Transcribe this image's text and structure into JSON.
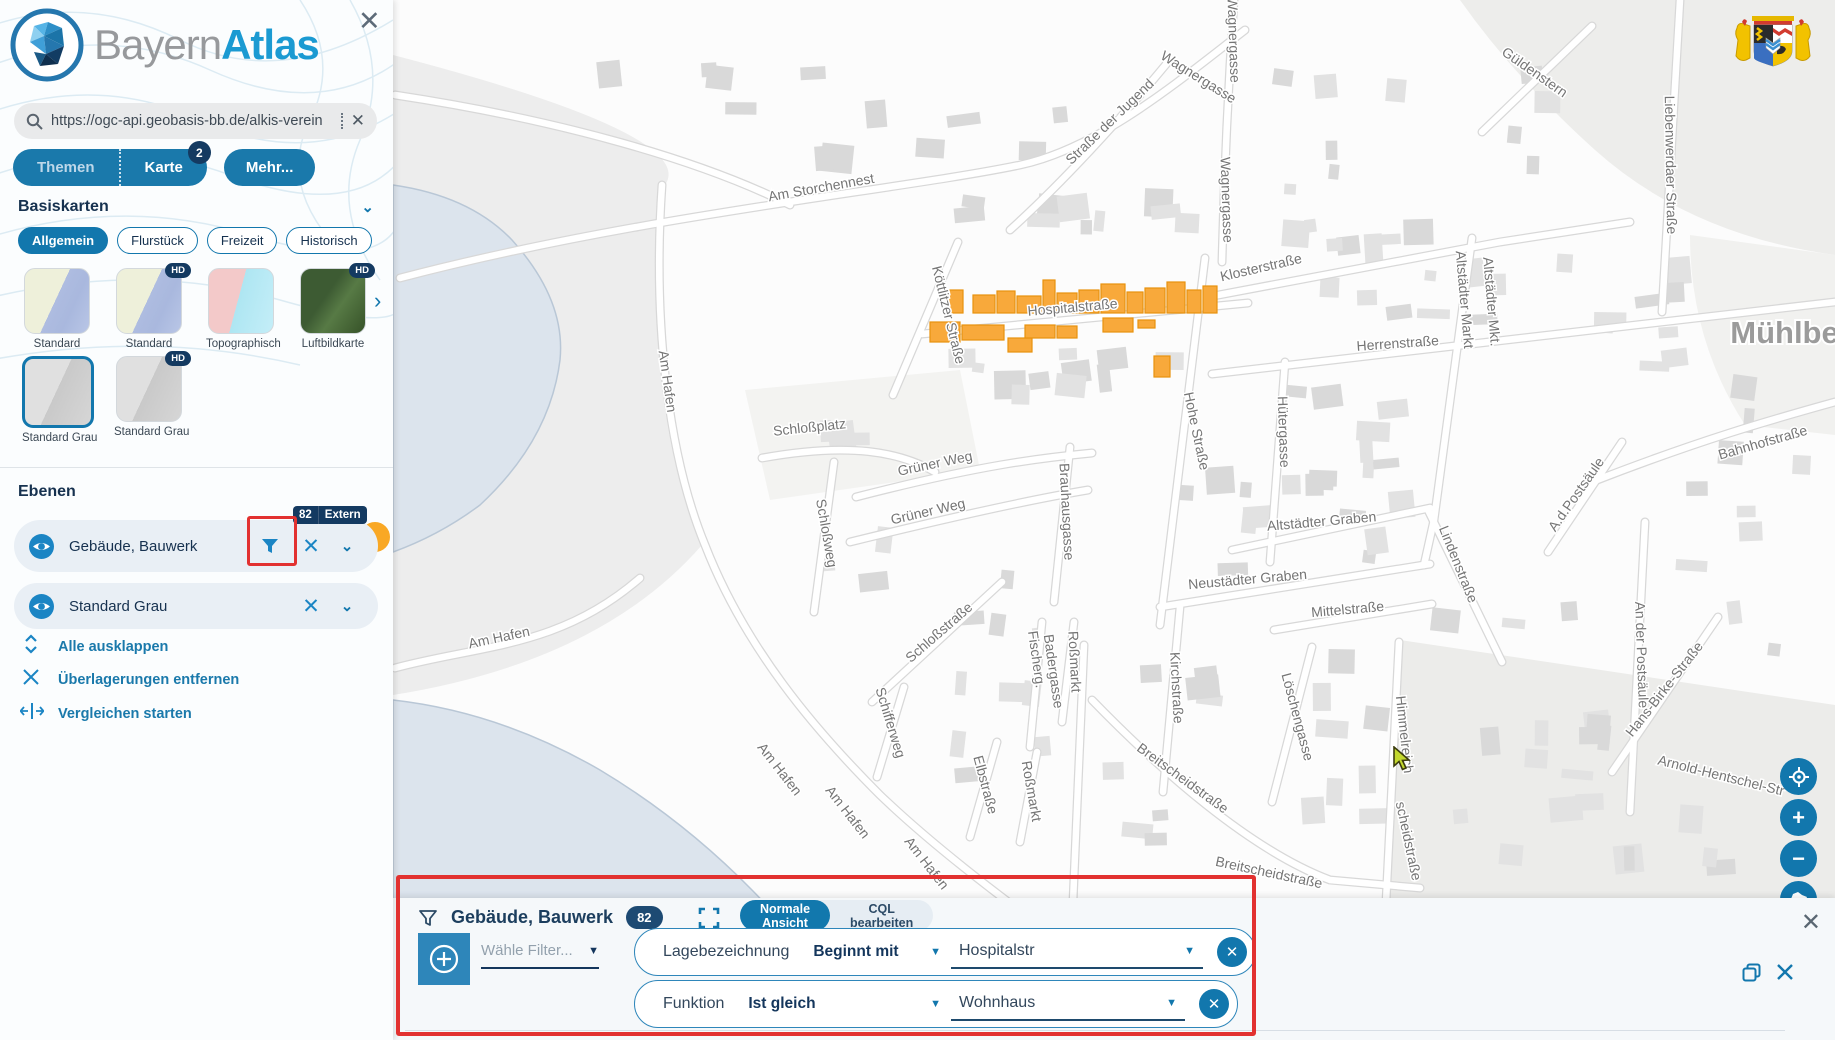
{
  "brand": {
    "name_light": "Bayern",
    "name_bold": "Atlas"
  },
  "sidebar": {
    "close_icon": "✕",
    "search": {
      "value": "https://ogc-api.geobasis-bb.de/alkis-verein",
      "clear_icon": "✕"
    },
    "tabs": {
      "themen": "Themen",
      "karte": "Karte",
      "karte_badge": "2",
      "more": "Mehr..."
    },
    "basemaps": {
      "heading": "Basiskarten",
      "collapse_icon": "⌄",
      "filters": [
        "Allgemein",
        "Flurstück",
        "Freizeit",
        "Historisch"
      ],
      "active_filter": "Allgemein",
      "next_icon": "›",
      "thumbs": [
        {
          "label": "Standard",
          "hd": false,
          "style": "map",
          "selected": false
        },
        {
          "label": "Standard",
          "hd": true,
          "style": "map",
          "selected": false
        },
        {
          "label": "Topographisch",
          "hd": false,
          "style": "topo",
          "selected": false
        },
        {
          "label": "Luftbildkarte",
          "hd": true,
          "style": "aerial",
          "selected": false
        },
        {
          "label": "Standard Grau",
          "hd": false,
          "style": "gray",
          "selected": true
        },
        {
          "label": "Standard Grau",
          "hd": true,
          "style": "gray",
          "selected": false
        }
      ],
      "hd_badge": "HD"
    },
    "layers": {
      "heading": "Ebenen",
      "badge_count": "82",
      "badge_tag": "Extern",
      "items": [
        {
          "label": "Gebäude, Bauwerk",
          "has_filter": true
        },
        {
          "label": "Standard Grau",
          "has_filter": false
        }
      ],
      "close_icon": "✕",
      "chevron_icon": "⌄"
    },
    "actions": [
      {
        "label": "Alle ausklappen",
        "icon": "expand-all-icon"
      },
      {
        "label": "Überlagerungen entfernen",
        "icon": "remove-overlays-icon"
      },
      {
        "label": "Vergleichen starten",
        "icon": "compare-icon"
      }
    ]
  },
  "filter_panel": {
    "title": "Gebäude, Bauwerk",
    "badge": "82",
    "views": [
      "Normale Ansicht",
      "CQL bearbeiten"
    ],
    "active_view": "Normale Ansicht",
    "select_placeholder": "Wähle Filter...",
    "rows": [
      {
        "field": "Lagebezeichnung",
        "operator": "Beginnt mit",
        "value": "Hospitalstr"
      },
      {
        "field": "Funktion",
        "operator": "Ist gleich",
        "value": "Wohnhaus"
      }
    ],
    "close_icon": "✕"
  },
  "map": {
    "city_label": "Mühlberg",
    "highlight_color": "#f8a93b",
    "highlight_stroke": "#e8920e",
    "water_color": "#dce4ed",
    "street_labels": [
      {
        "t": "Wagnergasse",
        "x": 1196,
        "y": 81,
        "r": 32
      },
      {
        "t": "Wagnergasse",
        "x": 1229,
        "y": 40,
        "r": 88
      },
      {
        "t": "Wagnergasse",
        "x": 1222,
        "y": 200,
        "r": 88
      },
      {
        "t": "Straße der Jugend",
        "x": 1113,
        "y": 125,
        "r": -44
      },
      {
        "t": "Am Storchennest",
        "x": 822,
        "y": 192,
        "r": -10
      },
      {
        "t": "Klosterstraße",
        "x": 1262,
        "y": 272,
        "r": -13
      },
      {
        "t": "Güldenstern",
        "x": 1532,
        "y": 76,
        "r": 35
      },
      {
        "t": "Liebenwerdaer Straße",
        "x": 1666,
        "y": 165,
        "r": 89
      },
      {
        "t": "Altstädter Markt",
        "x": 1460,
        "y": 300,
        "r": 85
      },
      {
        "t": "Altstädter Mkt.",
        "x": 1487,
        "y": 302,
        "r": 85
      },
      {
        "t": "Herrenstraße",
        "x": 1398,
        "y": 348,
        "r": -4
      },
      {
        "t": "Hohe Straße",
        "x": 1192,
        "y": 432,
        "r": 78
      },
      {
        "t": "Hütergasse",
        "x": 1279,
        "y": 432,
        "r": 88
      },
      {
        "t": "Bahnhofstraße",
        "x": 1764,
        "y": 447,
        "r": -16
      },
      {
        "t": "Lindenstraße",
        "x": 1454,
        "y": 566,
        "r": 68
      },
      {
        "t": "A.d.Postsäule",
        "x": 1580,
        "y": 497,
        "r": -55
      },
      {
        "t": "An der Postsäule",
        "x": 1637,
        "y": 655,
        "r": 88
      },
      {
        "t": "Altstädter Graben",
        "x": 1322,
        "y": 526,
        "r": -5
      },
      {
        "t": "Neustädter Graben",
        "x": 1248,
        "y": 584,
        "r": -5
      },
      {
        "t": "Mittelstraße",
        "x": 1348,
        "y": 614,
        "r": -5
      },
      {
        "t": "Kirchstraße",
        "x": 1172,
        "y": 688,
        "r": 87
      },
      {
        "t": "Löschengasse",
        "x": 1293,
        "y": 718,
        "r": 75
      },
      {
        "t": "Himmelreich",
        "x": 1400,
        "y": 735,
        "r": 84
      },
      {
        "t": "Breitscheidstraße",
        "x": 1180,
        "y": 782,
        "r": 36
      },
      {
        "t": "Breitscheidstraße",
        "x": 1268,
        "y": 877,
        "r": 12
      },
      {
        "t": "scheidstraße",
        "x": 1404,
        "y": 842,
        "r": 78
      },
      {
        "t": "Hans-Birke-Straße",
        "x": 1668,
        "y": 692,
        "r": -52
      },
      {
        "t": "Arnold-Hentschel-Str",
        "x": 1720,
        "y": 780,
        "r": 14
      },
      {
        "t": "Schloßplatz",
        "x": 810,
        "y": 432,
        "r": -6
      },
      {
        "t": "Schloßweg",
        "x": 822,
        "y": 534,
        "r": 80
      },
      {
        "t": "Grüner Weg",
        "x": 936,
        "y": 468,
        "r": -12
      },
      {
        "t": "Grüner Weg",
        "x": 929,
        "y": 516,
        "r": -13
      },
      {
        "t": "Schloßstraße",
        "x": 942,
        "y": 636,
        "r": -41
      },
      {
        "t": "Brauhausgasse",
        "x": 1062,
        "y": 512,
        "r": 87
      },
      {
        "t": "Fischerg.",
        "x": 1032,
        "y": 660,
        "r": 82
      },
      {
        "t": "Badergasse",
        "x": 1049,
        "y": 672,
        "r": 82
      },
      {
        "t": "Roßmarkt",
        "x": 1070,
        "y": 662,
        "r": 87
      },
      {
        "t": "Roßmarkt",
        "x": 1027,
        "y": 792,
        "r": 80
      },
      {
        "t": "Schifferweg",
        "x": 886,
        "y": 724,
        "r": 73
      },
      {
        "t": "Elbstraße",
        "x": 981,
        "y": 786,
        "r": 75
      },
      {
        "t": "Am Hafen",
        "x": 663,
        "y": 382,
        "r": 82
      },
      {
        "t": "Am Hafen",
        "x": 500,
        "y": 642,
        "r": -12
      },
      {
        "t": "Am Hafen",
        "x": 776,
        "y": 772,
        "r": 52
      },
      {
        "t": "Am Hafen",
        "x": 844,
        "y": 815,
        "r": 52
      },
      {
        "t": "Am Hafen",
        "x": 923,
        "y": 866,
        "r": 52
      },
      {
        "t": "Köttlitzer Straße",
        "x": 944,
        "y": 316,
        "r": 76
      },
      {
        "t": "Hospitalstraße",
        "x": 1073,
        "y": 312,
        "r": -5
      }
    ],
    "highlighted_buildings": [
      [
        948,
        290,
        15,
        23
      ],
      [
        973,
        295,
        22,
        18
      ],
      [
        997,
        291,
        18,
        22
      ],
      [
        1017,
        296,
        24,
        17
      ],
      [
        1043,
        280,
        12,
        33
      ],
      [
        1057,
        293,
        20,
        20
      ],
      [
        1079,
        290,
        20,
        23
      ],
      [
        1101,
        284,
        24,
        29
      ],
      [
        1127,
        292,
        16,
        21
      ],
      [
        1145,
        288,
        20,
        25
      ],
      [
        1167,
        282,
        18,
        31
      ],
      [
        1187,
        290,
        14,
        23
      ],
      [
        1203,
        286,
        14,
        27
      ],
      [
        930,
        322,
        30,
        20
      ],
      [
        962,
        325,
        42,
        15
      ],
      [
        1008,
        338,
        24,
        14
      ],
      [
        1025,
        325,
        30,
        13
      ],
      [
        1057,
        326,
        20,
        12
      ],
      [
        1103,
        318,
        30,
        14
      ],
      [
        1138,
        320,
        17,
        8
      ],
      [
        1154,
        356,
        16,
        21
      ]
    ],
    "controls": [
      "geolocate",
      "zoom-in",
      "zoom-out",
      "bavaria-extent"
    ]
  },
  "colors": {
    "primary": "#1277ad",
    "primary_dark": "#143a61",
    "accent_orange": "#f9a825",
    "annotation_red": "#e23130",
    "link_blue": "#1a79ab"
  }
}
